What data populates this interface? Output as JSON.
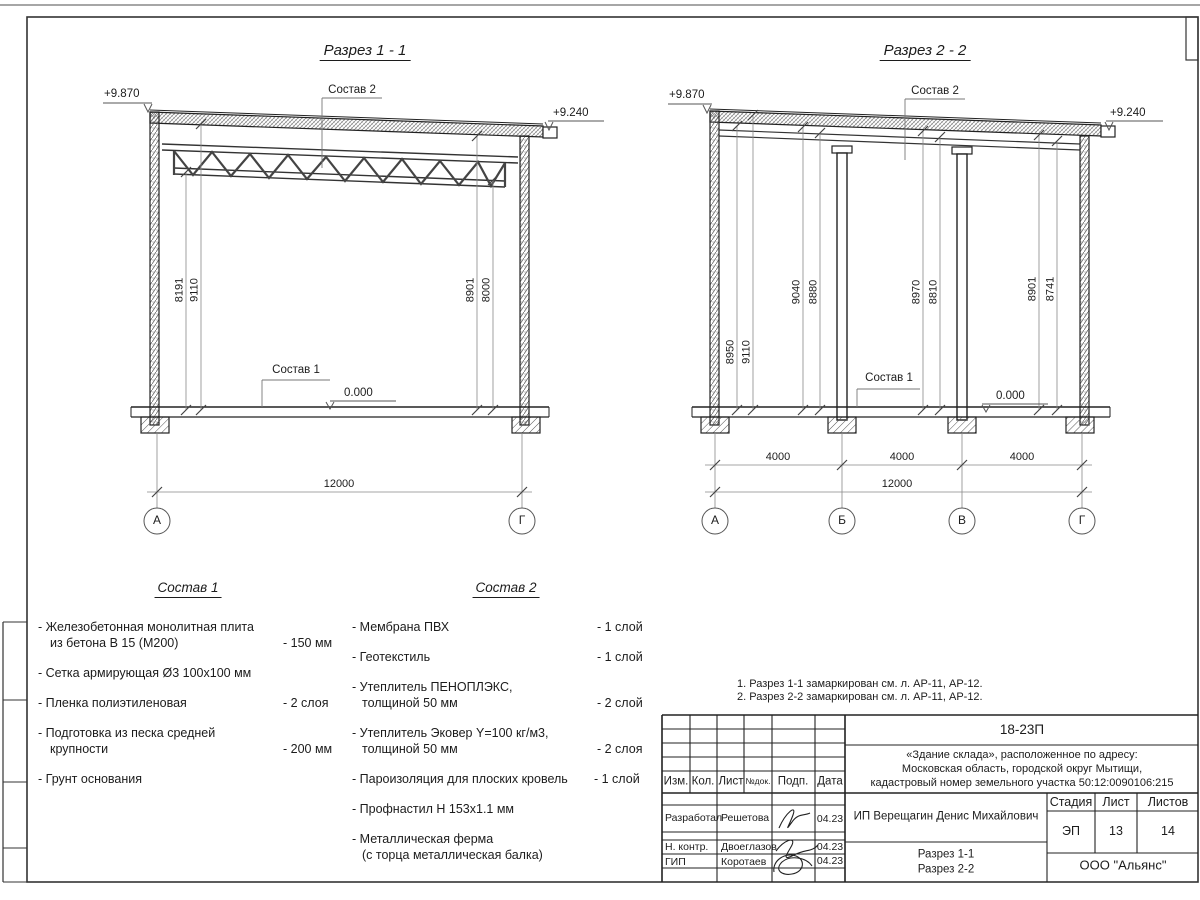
{
  "s1": {
    "title": "Разрез 1 - 1",
    "elev_left": "+9.870",
    "elev_right": "+9.240",
    "elev_zero": "0.000",
    "label_roof": "Состав 2",
    "label_floor": "Состав 1",
    "dims_left": [
      "8191",
      "9110"
    ],
    "dims_right": [
      "8901",
      "8000"
    ],
    "dim_total": "12000",
    "axes": [
      "А",
      "Г"
    ]
  },
  "s2": {
    "title": "Разрез 2 - 2",
    "elev_left": "+9.870",
    "elev_right": "+9.240",
    "elev_zero": "0.000",
    "label_roof": "Состав 2",
    "label_floor": "Состав 1",
    "dims": [
      "8950",
      "9110",
      "9040",
      "8880",
      "8970",
      "8810",
      "8901",
      "8741"
    ],
    "dim_spans": [
      "4000",
      "4000",
      "4000"
    ],
    "dim_total": "12000",
    "axes": [
      "А",
      "Б",
      "В",
      "Г"
    ]
  },
  "sostav1": {
    "title": "Состав 1",
    "items": [
      {
        "l1": "- Железобетонная  монолитная плита",
        "l2": "из бетона В 15 (М200)",
        "val": "- 150 мм"
      },
      {
        "l1": "- Сетка армирующая Ø3 100х100 мм",
        "l2": "",
        "val": ""
      },
      {
        "l1": "- Пленка полиэтиленовая",
        "l2": "",
        "val": "-  2 слоя"
      },
      {
        "l1": "- Подготовка из песка средней",
        "l2": "крупности",
        "val": "- 200 мм"
      },
      {
        "l1": "- Грунт основания",
        "l2": "",
        "val": ""
      }
    ]
  },
  "sostav2": {
    "title": "Состав 2",
    "items": [
      {
        "l1": "- Мембрана ПВХ",
        "l2": "",
        "val": "- 1 слой"
      },
      {
        "l1": "- Геотекстиль",
        "l2": "",
        "val": "- 1 слой"
      },
      {
        "l1": "- Утеплитель ПЕНОПЛЭКС,",
        "l2": "толщиной 50 мм",
        "val": "- 2 слой"
      },
      {
        "l1": "- Утеплитель Эковер Y=100 кг/м3,",
        "l2": "толщиной 50 мм",
        "val": "- 2 слоя"
      },
      {
        "l1": "- Пароизоляция для плоских кровель",
        "l2": "",
        "val": "- 1 слой"
      },
      {
        "l1": "- Профнастил Н 153х1.1 мм",
        "l2": "",
        "val": ""
      },
      {
        "l1": "- Металлическая ферма",
        "l2": "(с торца металлическая балка)",
        "val": ""
      }
    ]
  },
  "notes": {
    "lines": [
      "1. Разрез 1-1 замаркирован см. л. АР-11, АР-12.",
      "2. Разрез 2-2 замаркирован см. л. АР-11, АР-12."
    ]
  },
  "titleblock": {
    "code": "18-23П",
    "address": [
      "«Здание склада», расположенное по адресу:",
      "Московская область, городской округ Мытищи,",
      "кадастровый номер земельного участка 50:12:0090106:215"
    ],
    "cols": [
      "Изм.",
      "Кол.",
      "Лист",
      "№док.",
      "Подп.",
      "Дата"
    ],
    "rows": [
      {
        "role": "Разработал",
        "name": "Решетова",
        "date": "04.23"
      },
      {
        "role": "Н. контр.",
        "name": "Двоеглазов",
        "date": "04.23"
      },
      {
        "role": "ГИП",
        "name": "Коротаев",
        "date": "04.23"
      }
    ],
    "customer": "ИП Верещагин Денис Михайлович",
    "stage_headers": [
      "Стадия",
      "Лист",
      "Листов"
    ],
    "stage_values": [
      "ЭП",
      "13",
      "14"
    ],
    "sheet_title": [
      "Разрез 1-1",
      "Разрез 2-2"
    ],
    "company": "ООО \"Альянс\""
  }
}
